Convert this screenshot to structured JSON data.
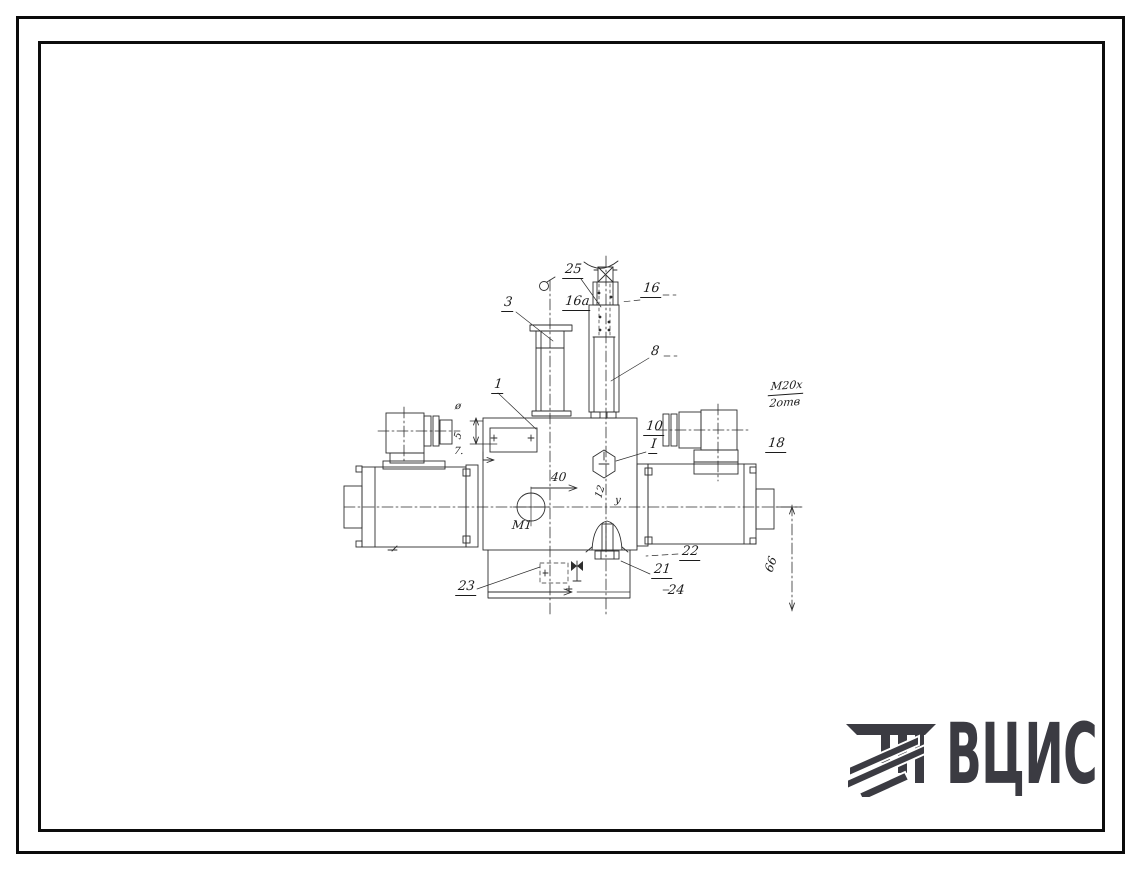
{
  "logo": {
    "text": "ВЦИС",
    "color": "#3b3b42",
    "icon": "column-with-diagonal-stripes-icon"
  },
  "drawing": {
    "callouts": [
      {
        "label": "25"
      },
      {
        "label": "16"
      },
      {
        "label": "16а"
      },
      {
        "label": "3"
      },
      {
        "label": "8"
      },
      {
        "label": "1"
      },
      {
        "label": "10"
      },
      {
        "label": "I"
      },
      {
        "label": "18"
      },
      {
        "label": "22"
      },
      {
        "label": "21"
      },
      {
        "label": "24"
      },
      {
        "label": "23"
      }
    ],
    "dimensions": [
      {
        "label": "40"
      },
      {
        "label": "М1"
      },
      {
        "label": "12"
      },
      {
        "label": "у"
      },
      {
        "label": "66"
      },
      {
        "label": "ø"
      },
      {
        "label": "5"
      },
      {
        "label": "7."
      }
    ],
    "thread_note": {
      "top": "М20х",
      "bottom": "2отв"
    }
  }
}
